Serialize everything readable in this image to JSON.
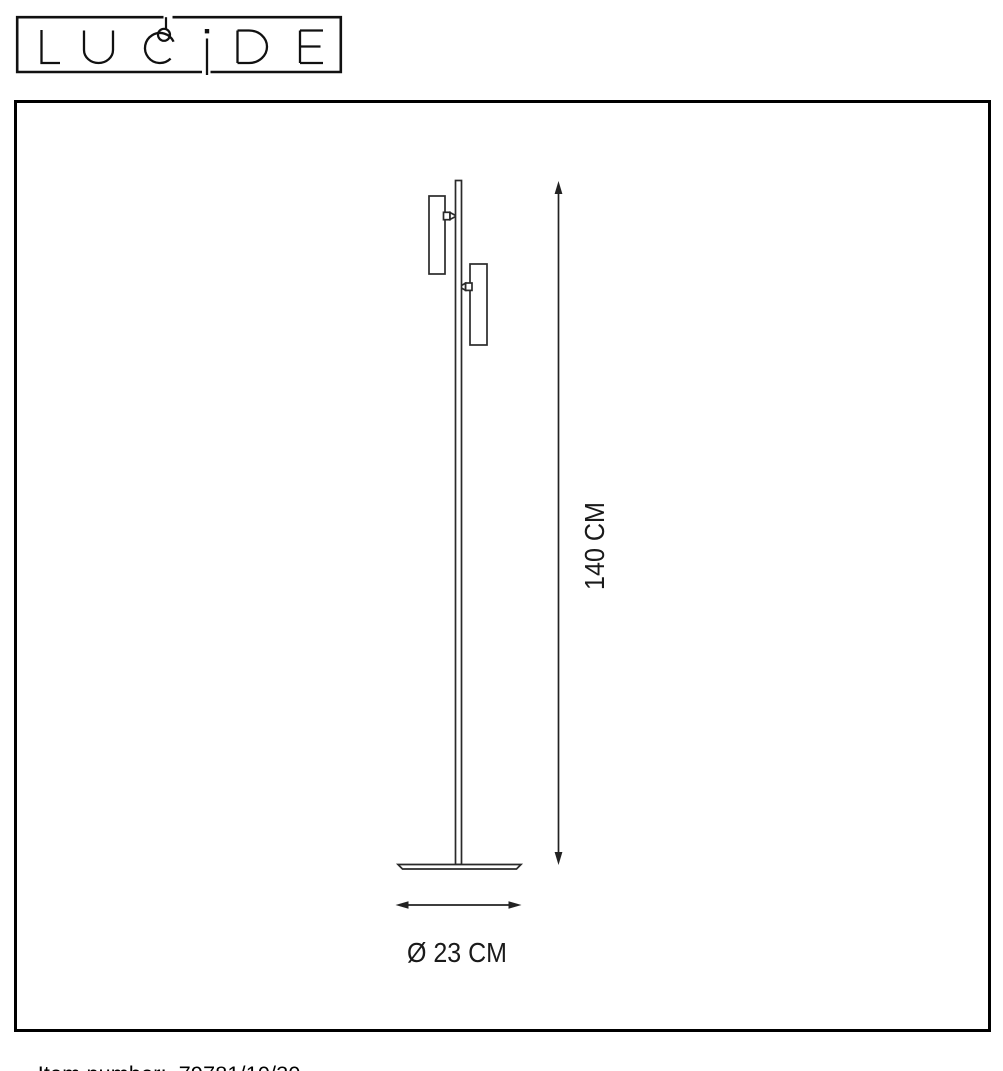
{
  "logo": {
    "brand": "LUCIDE"
  },
  "diagram": {
    "height_label": "140 CM",
    "diameter_label": "Ø 23 CM"
  },
  "footer": {
    "item_label": "Item number:",
    "item_number": "79781/10/30"
  },
  "icons": {
    "pendant_lamp": "hanging-bulb-in-logo-C",
    "height_dimension": "double-headed-arrow-vertical",
    "diameter_dimension": "double-headed-arrow-horizontal"
  },
  "colors": {
    "background": "#ffffff",
    "outline": "#000000",
    "drawing_line": "#2a2a2a",
    "dimension_line": "#222222",
    "text": "#1a1a1a"
  }
}
